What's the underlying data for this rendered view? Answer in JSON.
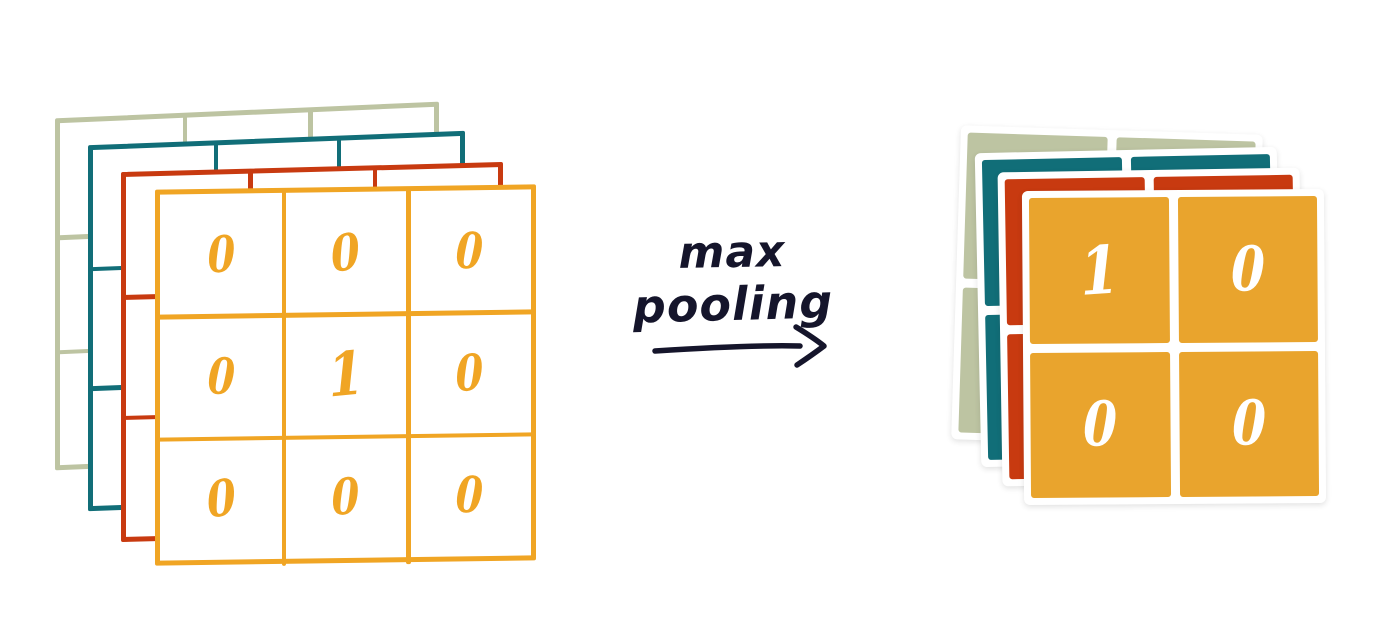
{
  "operation": {
    "line1": "max",
    "line2": "pooling"
  },
  "input_grid": {
    "rows": 3,
    "cols": 3,
    "values": [
      [
        "0",
        "0",
        "0"
      ],
      [
        "0",
        "1",
        "0"
      ],
      [
        "0",
        "0",
        "0"
      ]
    ]
  },
  "output_grid": {
    "rows": 2,
    "cols": 2,
    "values": [
      [
        "1",
        "0"
      ],
      [
        "0",
        "0"
      ]
    ]
  },
  "layers": {
    "names": [
      "sage",
      "teal",
      "red",
      "yellow"
    ],
    "count": 4
  },
  "colors": {
    "sage": "#bdc4a2",
    "teal": "#116e78",
    "red": "#c83a10",
    "yellow": "#f0a524",
    "yellow_fill": "#e9a42d",
    "ink": "#15152b",
    "background": "#ffffff"
  }
}
